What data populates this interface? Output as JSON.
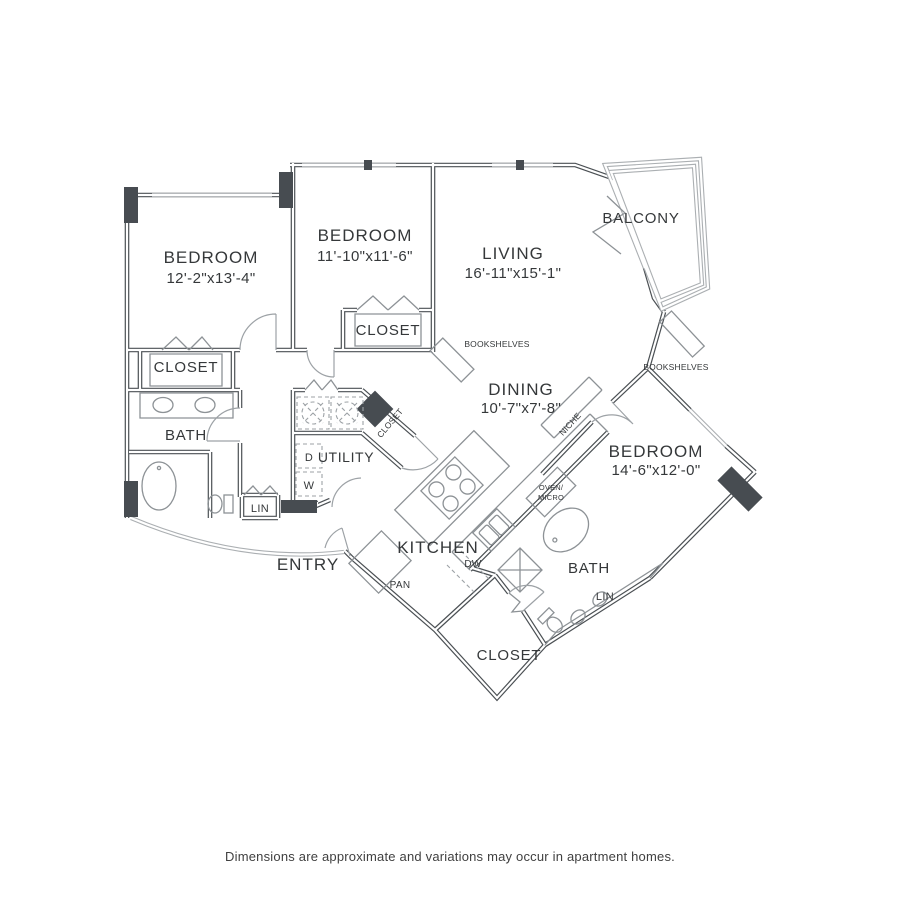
{
  "page": {
    "background_color": "#ffffff",
    "disclaimer": "Dimensions are approximate and variations may occur in apartment homes."
  },
  "floor_plan": {
    "type": "apartment-floor-plan",
    "wall_color": "#4b5054",
    "post_color": "#474c51",
    "labels": {
      "bedroom1": {
        "name": "BEDROOM",
        "dims": "12'-2\"x13'-4\""
      },
      "bedroom2": {
        "name": "BEDROOM",
        "dims": "11'-10\"x11'-6\""
      },
      "living": {
        "name": "LIVING",
        "dims": "16'-11\"x15'-1\""
      },
      "dining": {
        "name": "DINING",
        "dims": "10'-7\"x7'-8\""
      },
      "bedroom3": {
        "name": "BEDROOM",
        "dims": "14'-6\"x12'-0\""
      },
      "balcony": "BALCONY",
      "kitchen": "KITCHEN",
      "entry": "ENTRY",
      "bath_left": "BATH",
      "bath_right": "BATH",
      "utility": "UTILITY",
      "closet_bedroom1": "CLOSET",
      "closet_bedroom2": "CLOSET",
      "closet_hall": "CLOSET",
      "closet_bottom": "CLOSET",
      "lin_left": "LIN",
      "lin_right": "LIN",
      "niche": "NICHE",
      "bookshelves_living": "BOOKSHELVES",
      "bookshelves_bedroom3": "BOOKSHELVES",
      "pantry": "PAN",
      "dishwasher": "DW",
      "dryer": "D",
      "washer": "W",
      "oven_micro_line1": "OVEN/",
      "oven_micro_line2": "MICRO"
    }
  }
}
